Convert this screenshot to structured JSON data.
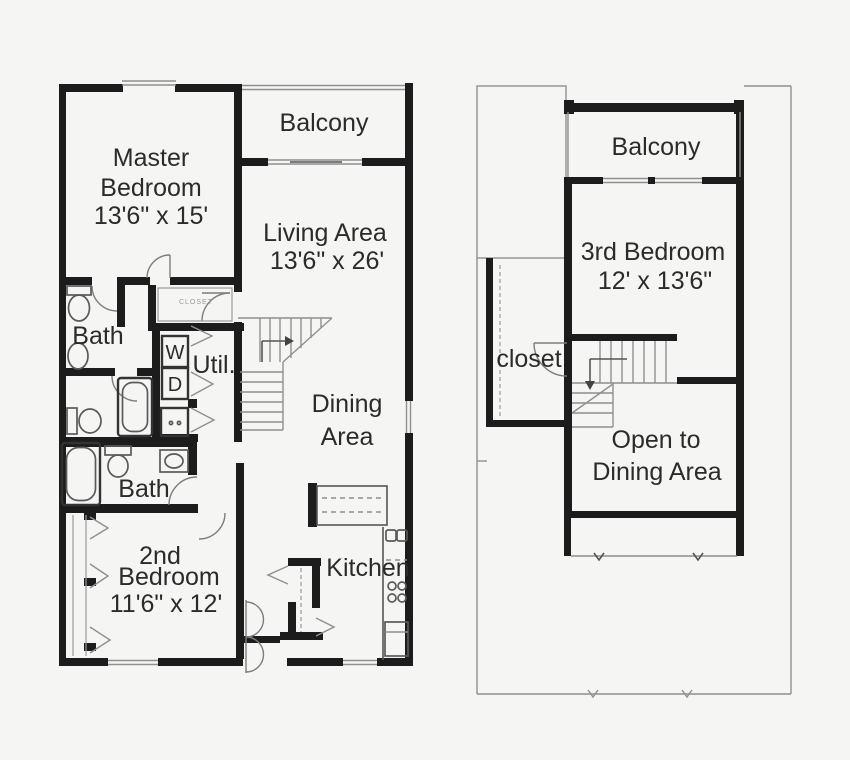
{
  "document": {
    "type": "architectural-floor-plan",
    "style": "black-line drawing on off-white background"
  },
  "colors": {
    "background": "#f5f5f3",
    "wall": "#1c1c1c",
    "thin_line": "#8f8f8f",
    "text": "#2b2b2b"
  },
  "first_floor": {
    "balcony": "Balcony",
    "master_bedroom": [
      "Master",
      "Bedroom",
      "13'6\" x 15'"
    ],
    "living_area": [
      "Living Area",
      "13'6\" x 26'"
    ],
    "bath_upper": "Bath",
    "closet_small": "CLOSET",
    "washer": "W",
    "dryer": "D",
    "utility": "Util.",
    "dining_area": [
      "Dining",
      "Area"
    ],
    "bath_lower": "Bath",
    "second_bedroom": [
      "2nd",
      "Bedroom",
      "11'6\" x 12'"
    ],
    "kitchen": "Kitchen"
  },
  "second_floor": {
    "balcony": "Balcony",
    "third_bedroom": [
      "3rd Bedroom",
      "12' x 13'6\""
    ],
    "closet": "closet",
    "open_to_dining": [
      "Open to",
      "Dining Area"
    ]
  }
}
